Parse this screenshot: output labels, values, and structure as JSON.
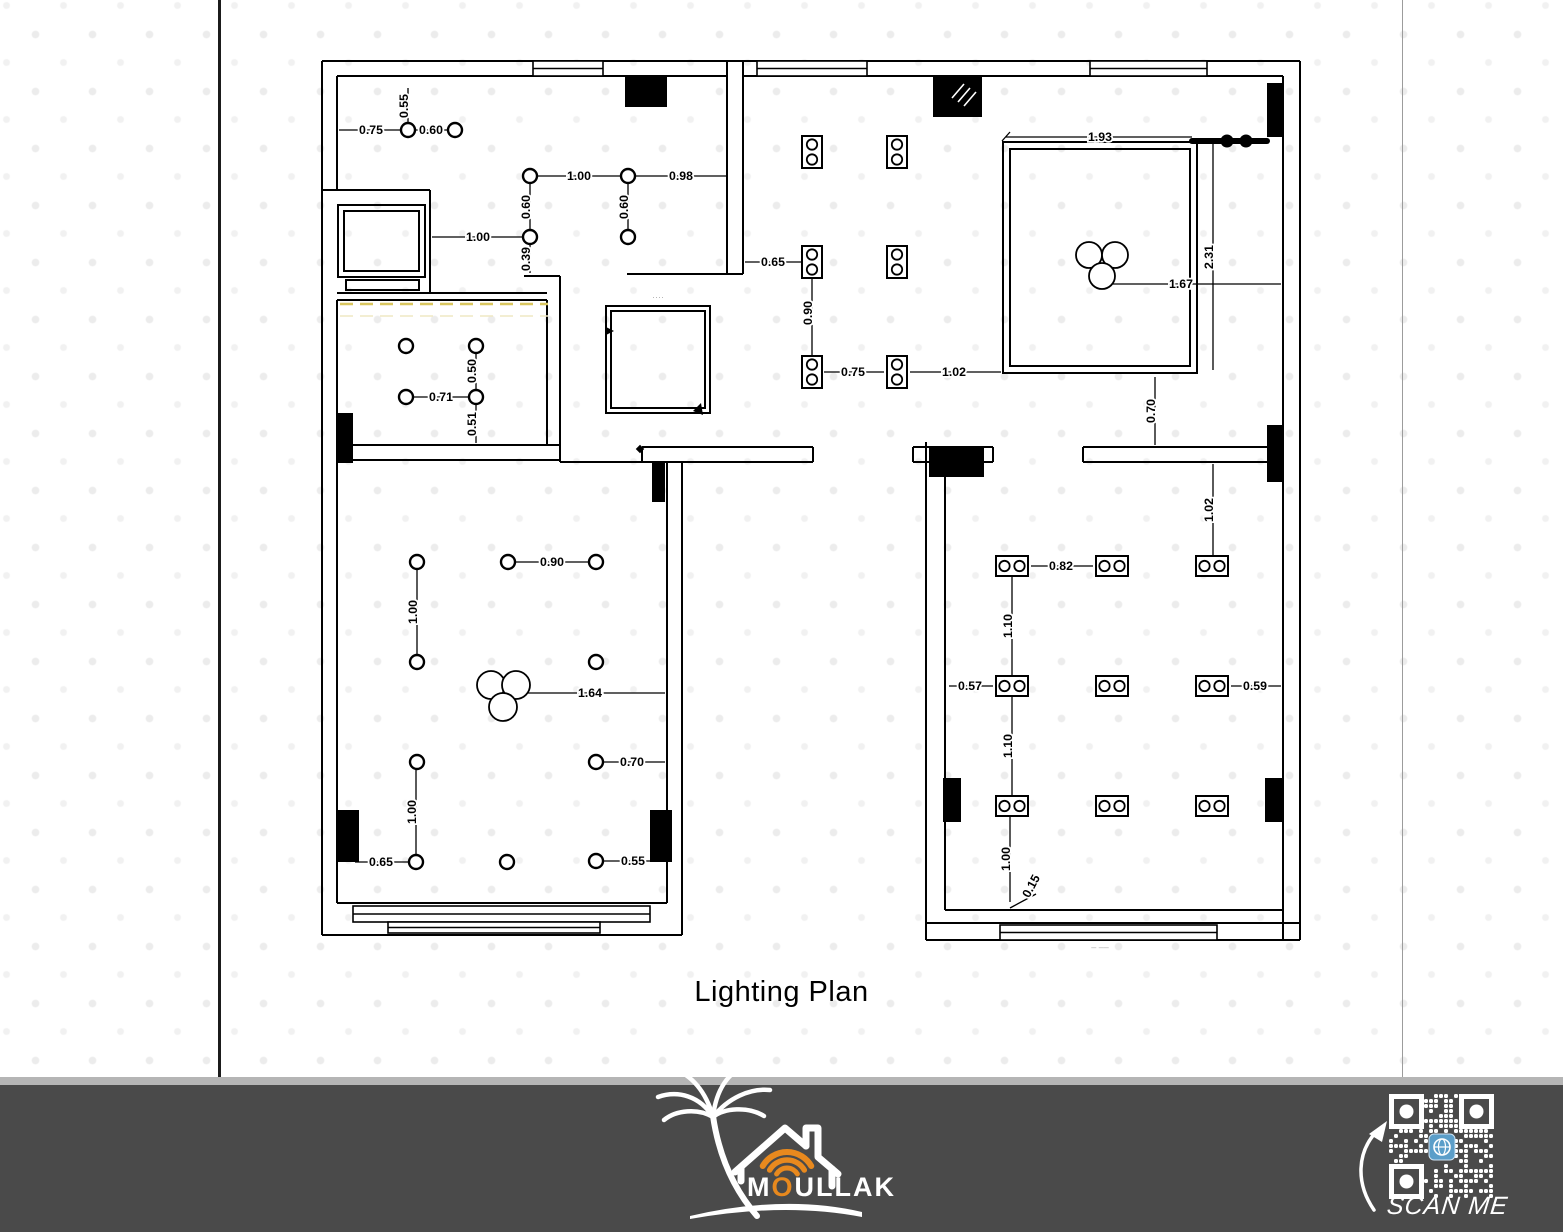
{
  "title": "Lighting Plan",
  "footer": {
    "brand_pre": "M",
    "brand_o": "O",
    "brand_post": "ULLAK",
    "scan_me": "SCAN ME"
  },
  "colors": {
    "accent_orange": "#E8891E",
    "footer_bg": "#4A4A4A",
    "footer_band": "#B5B5B5",
    "qr_globe_blue": "#5B9EC9",
    "yellow_dash": "#D9C65F",
    "dot_pattern": "#ECECEC"
  },
  "plan": {
    "dimensions": [
      {
        "label": "0.55",
        "orient": "v",
        "line": [
          408,
          88,
          408,
          123
        ],
        "lx": 404,
        "ly": 106
      },
      {
        "label": "0.75",
        "orient": "h",
        "line": [
          339,
          130,
          401,
          130
        ],
        "lx": 371,
        "ly": 130
      },
      {
        "label": "0.60",
        "orient": "h",
        "line": [
          415,
          130,
          448,
          130
        ],
        "lx": 431,
        "ly": 130
      },
      {
        "label": "1.00",
        "orient": "h",
        "line": [
          537,
          176,
          621,
          176
        ],
        "lx": 579,
        "ly": 176
      },
      {
        "label": "0.98",
        "orient": "h",
        "line": [
          635,
          176,
          727,
          176
        ],
        "lx": 681,
        "ly": 176
      },
      {
        "label": "0.60",
        "orient": "v",
        "line": [
          530,
          183,
          530,
          230
        ],
        "lx": 526,
        "ly": 207
      },
      {
        "label": "0.60",
        "orient": "v",
        "line": [
          628,
          183,
          628,
          230
        ],
        "lx": 624,
        "ly": 207
      },
      {
        "label": "1.00",
        "orient": "h",
        "line": [
          432,
          237,
          523,
          237
        ],
        "lx": 478,
        "ly": 237
      },
      {
        "label": "0.39",
        "orient": "v",
        "line": [
          530,
          244,
          530,
          273
        ],
        "lx": 526,
        "ly": 259
      },
      {
        "label": "0.50",
        "orient": "v",
        "line": [
          476,
          352,
          476,
          390
        ],
        "lx": 472,
        "ly": 371
      },
      {
        "label": "0.71",
        "orient": "h",
        "line": [
          413,
          397,
          469,
          397
        ],
        "lx": 441,
        "ly": 397
      },
      {
        "label": "0.51",
        "orient": "v",
        "line": [
          476,
          404,
          476,
          443
        ],
        "lx": 472,
        "ly": 424
      },
      {
        "label": "0.90",
        "orient": "h",
        "line": [
          515,
          562,
          589,
          562
        ],
        "lx": 552,
        "ly": 562
      },
      {
        "label": "1.00",
        "orient": "v",
        "line": [
          417,
          569,
          417,
          655
        ],
        "lx": 413,
        "ly": 612
      },
      {
        "label": "1.64",
        "orient": "h",
        "line": [
          517,
          693,
          665,
          693
        ],
        "lx": 590,
        "ly": 693
      },
      {
        "label": "0.70",
        "orient": "h",
        "line": [
          603,
          762,
          665,
          762
        ],
        "lx": 632,
        "ly": 762
      },
      {
        "label": "1.00",
        "orient": "v",
        "line": [
          416,
          769,
          416,
          855
        ],
        "lx": 412,
        "ly": 812
      },
      {
        "label": "0.65",
        "orient": "h",
        "line": [
          355,
          862,
          409,
          862
        ],
        "lx": 381,
        "ly": 862
      },
      {
        "label": "0.55",
        "orient": "h",
        "line": [
          603,
          861,
          665,
          861
        ],
        "lx": 633,
        "ly": 861
      },
      {
        "label": "0.65",
        "orient": "h",
        "line": [
          745,
          262,
          805,
          262
        ],
        "lx": 773,
        "ly": 262
      },
      {
        "label": "0.90",
        "orient": "v",
        "line": [
          812,
          269,
          812,
          360
        ],
        "lx": 808,
        "ly": 313
      },
      {
        "label": "0.75",
        "orient": "h",
        "line": [
          824,
          372,
          884,
          372
        ],
        "lx": 853,
        "ly": 372
      },
      {
        "label": "1.02",
        "orient": "h",
        "line": [
          910,
          372,
          1001,
          372
        ],
        "lx": 954,
        "ly": 372
      },
      {
        "label": "1.93",
        "orient": "h",
        "line": [
          1006,
          137,
          1192,
          137
        ],
        "lx": 1100,
        "ly": 137
      },
      {
        "label": "2.31",
        "orient": "v",
        "line": [
          1213,
          143,
          1213,
          370
        ],
        "lx": 1209,
        "ly": 257
      },
      {
        "label": "1.67",
        "orient": "h",
        "line": [
          1104,
          284,
          1281,
          284
        ],
        "lx": 1181,
        "ly": 284
      },
      {
        "label": "0.70",
        "orient": "v",
        "line": [
          1155,
          377,
          1155,
          445
        ],
        "lx": 1151,
        "ly": 411
      },
      {
        "label": "1.02",
        "orient": "v",
        "line": [
          1213,
          464,
          1213,
          556
        ],
        "lx": 1209,
        "ly": 510
      },
      {
        "label": "0.82",
        "orient": "h",
        "line": [
          1031,
          566,
          1093,
          566
        ],
        "lx": 1061,
        "ly": 566
      },
      {
        "label": "1.10",
        "orient": "v",
        "line": [
          1012,
          576,
          1012,
          676
        ],
        "lx": 1008,
        "ly": 626
      },
      {
        "label": "0.57",
        "orient": "h",
        "line": [
          949,
          686,
          993,
          686
        ],
        "lx": 970,
        "ly": 686
      },
      {
        "label": "0.59",
        "orient": "h",
        "line": [
          1231,
          686,
          1281,
          686
        ],
        "lx": 1255,
        "ly": 686
      },
      {
        "label": "1.10",
        "orient": "v",
        "line": [
          1012,
          696,
          1012,
          796
        ],
        "lx": 1008,
        "ly": 746
      },
      {
        "label": "1.00",
        "orient": "v",
        "line": [
          1010,
          816,
          1010,
          902
        ],
        "lx": 1006,
        "ly": 859
      },
      {
        "label": "0.15",
        "orient": "r",
        "rot": -62,
        "line": [
          1010,
          908,
          1036,
          894
        ],
        "lx": 1031,
        "ly": 886
      }
    ],
    "downlights": [
      [
        408,
        130
      ],
      [
        455,
        130
      ],
      [
        530,
        176
      ],
      [
        628,
        176
      ],
      [
        530,
        237
      ],
      [
        628,
        237
      ],
      [
        406,
        346
      ],
      [
        476,
        346
      ],
      [
        406,
        397
      ],
      [
        476,
        397
      ],
      [
        417,
        562
      ],
      [
        508,
        562
      ],
      [
        596,
        562
      ],
      [
        417,
        662
      ],
      [
        596,
        662
      ],
      [
        417,
        762
      ],
      [
        596,
        762
      ],
      [
        416,
        862
      ],
      [
        507,
        862
      ],
      [
        596,
        861
      ]
    ],
    "spot_pairs_vertical": [
      [
        812,
        152
      ],
      [
        897,
        152
      ],
      [
        812,
        262
      ],
      [
        897,
        262
      ],
      [
        812,
        372
      ],
      [
        897,
        372
      ]
    ],
    "spot_pairs_horizontal": [
      [
        1012,
        566
      ],
      [
        1112,
        566
      ],
      [
        1212,
        566
      ],
      [
        1012,
        686
      ],
      [
        1112,
        686
      ],
      [
        1212,
        686
      ],
      [
        1012,
        806
      ],
      [
        1112,
        806
      ],
      [
        1212,
        806
      ]
    ],
    "chandeliers": [
      {
        "circles": [
          [
            1089,
            255,
            13
          ],
          [
            1115,
            255,
            13
          ],
          [
            1102,
            276,
            13
          ]
        ]
      },
      {
        "circles": [
          [
            491,
            685,
            14
          ],
          [
            516,
            685,
            14
          ],
          [
            503,
            707,
            14
          ]
        ]
      }
    ],
    "track_light": {
      "bar": [
        1192,
        141,
        1267,
        141
      ],
      "dots": [
        [
          1227,
          141
        ],
        [
          1246,
          141
        ]
      ]
    },
    "yellow_dashed_lines": [
      {
        "line": [
          340,
          304,
          548,
          304
        ],
        "strong": true
      },
      {
        "line": [
          340,
          316,
          548,
          316
        ],
        "strong": false
      }
    ],
    "faint_marks": [
      {
        "text": "– ––",
        "x": 1100,
        "y": 950
      },
      {
        "text": "····",
        "x": 658,
        "y": 300
      }
    ]
  }
}
